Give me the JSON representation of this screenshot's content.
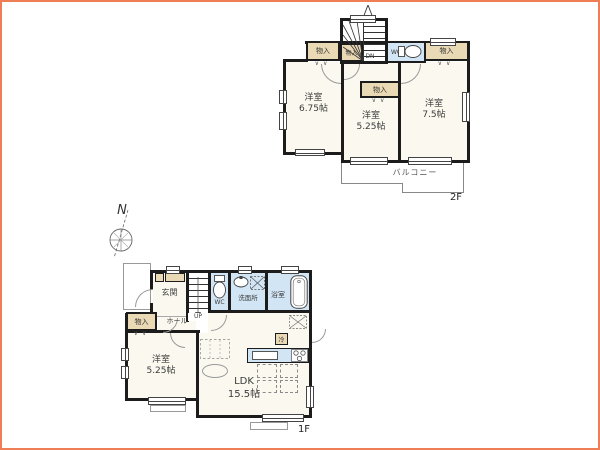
{
  "compass": {
    "north": "N"
  },
  "floor2": {
    "label": "2F",
    "room_left": {
      "name": "洋室",
      "size": "6.75帖"
    },
    "room_mid": {
      "name": "洋室",
      "size": "5.25帖"
    },
    "room_right": {
      "name": "洋室",
      "size": "7.5帖"
    },
    "closet": "物入",
    "wc": "WC",
    "stairs": "DN",
    "balcony": "バルコニー"
  },
  "floor1": {
    "label": "1F",
    "entrance": "玄関",
    "hall": "ホール",
    "wc": "WC",
    "washroom": "洗面所",
    "bath": "浴室",
    "closet": "物入",
    "room": {
      "name": "洋室",
      "size": "5.25帖"
    },
    "ldk": {
      "name": "LDK",
      "size": "15.5帖"
    },
    "fridge": "冷",
    "stairs": "UP"
  },
  "symbols": {
    "folding_door": "∨∨"
  },
  "colors": {
    "frame": "#ef7d55",
    "wall": "#1c1c1c",
    "room_fill": "#fbf9ef",
    "closet_fill": "#e9d9b4",
    "wet_fill": "#d2e5f4"
  }
}
